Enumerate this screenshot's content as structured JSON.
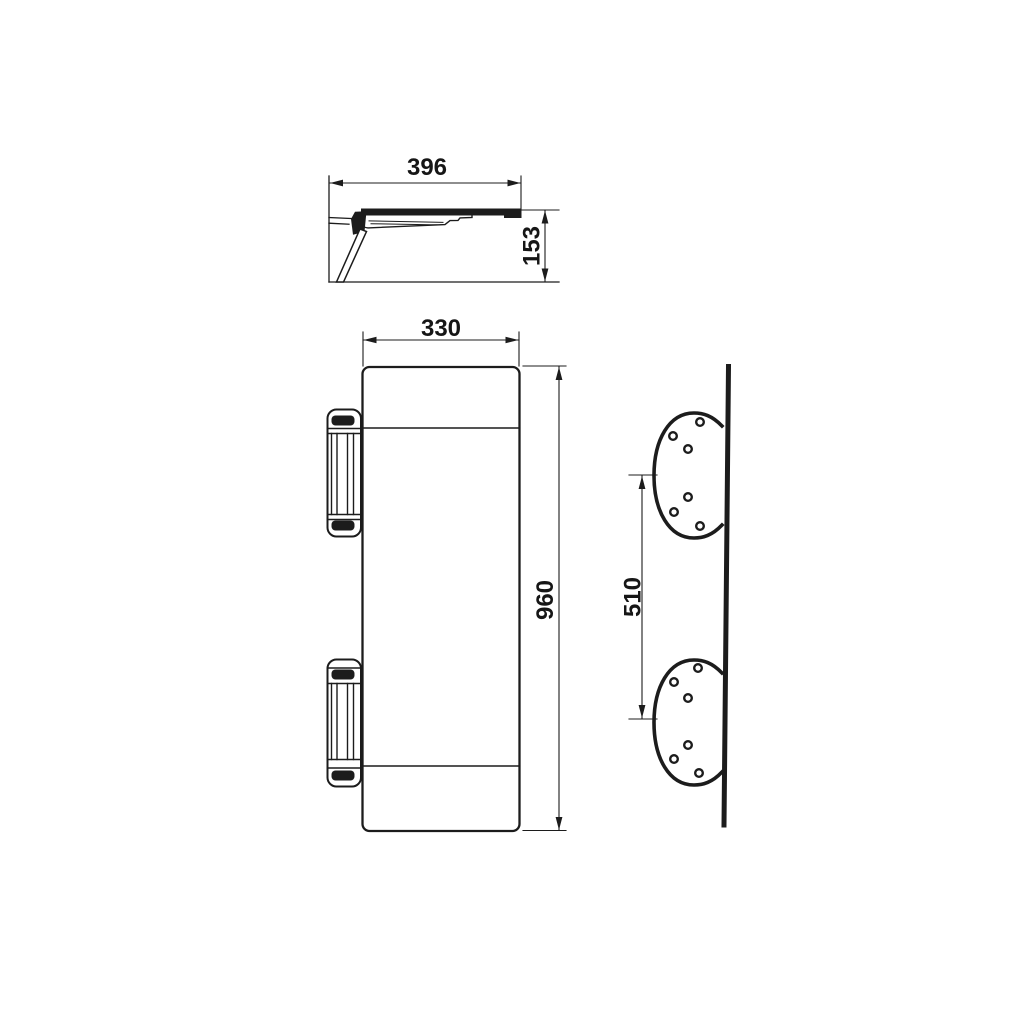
{
  "page": {
    "background_color": "#ffffff"
  },
  "drawing": {
    "stroke_color": "#1c1c1c",
    "dimensions": {
      "depth": {
        "label": "396"
      },
      "height": {
        "label": "153"
      },
      "width": {
        "label": "330"
      },
      "length": {
        "label": "960"
      },
      "plate_spacing": {
        "label": "510"
      }
    }
  }
}
